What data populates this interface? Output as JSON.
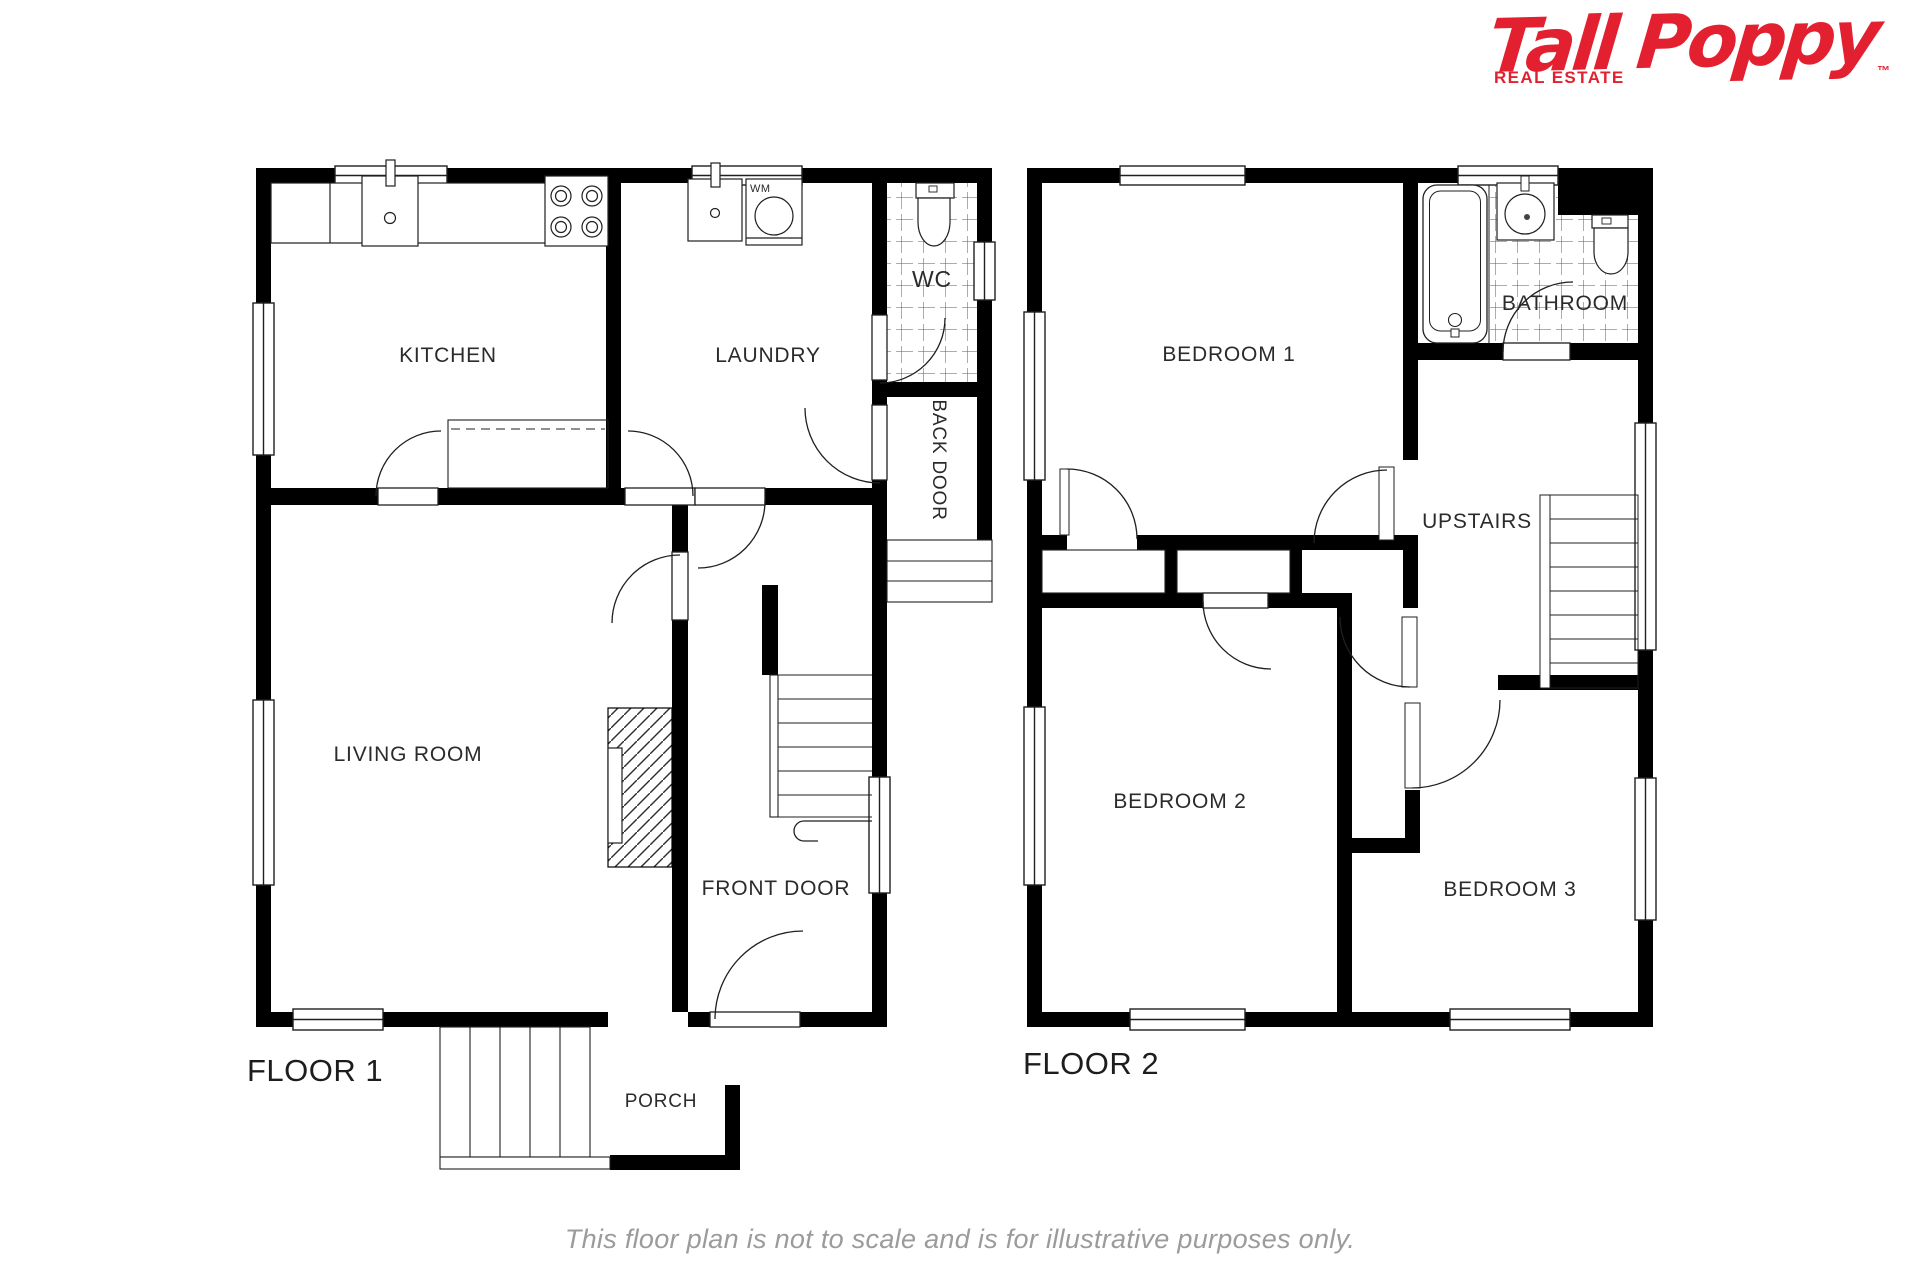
{
  "brand": {
    "name": "Tall Poppy",
    "trademark": "™",
    "tagline": "REAL ESTATE",
    "color": "#e3202f"
  },
  "floors": {
    "floor1": {
      "title": "FLOOR 1",
      "rooms": {
        "kitchen": "KITCHEN",
        "laundry": "LAUNDRY",
        "wc": "WC",
        "back_door": "BACK DOOR",
        "living_room": "LIVING ROOM",
        "front_door": "FRONT DOOR",
        "porch": "PORCH"
      },
      "appliances": {
        "washing_machine": "WM"
      }
    },
    "floor2": {
      "title": "FLOOR 2",
      "rooms": {
        "bedroom1": "BEDROOM 1",
        "bathroom": "BATHROOM",
        "upstairs": "UPSTAIRS",
        "bedroom2": "BEDROOM 2",
        "bedroom3": "BEDROOM 3"
      }
    }
  },
  "footer": {
    "disclaimer": "This floor plan is not to scale and is for illustrative purposes only."
  },
  "colors": {
    "wall": "#000000",
    "label": "#2b2b2b",
    "disclaimer_gray": "#9b9b9b"
  }
}
